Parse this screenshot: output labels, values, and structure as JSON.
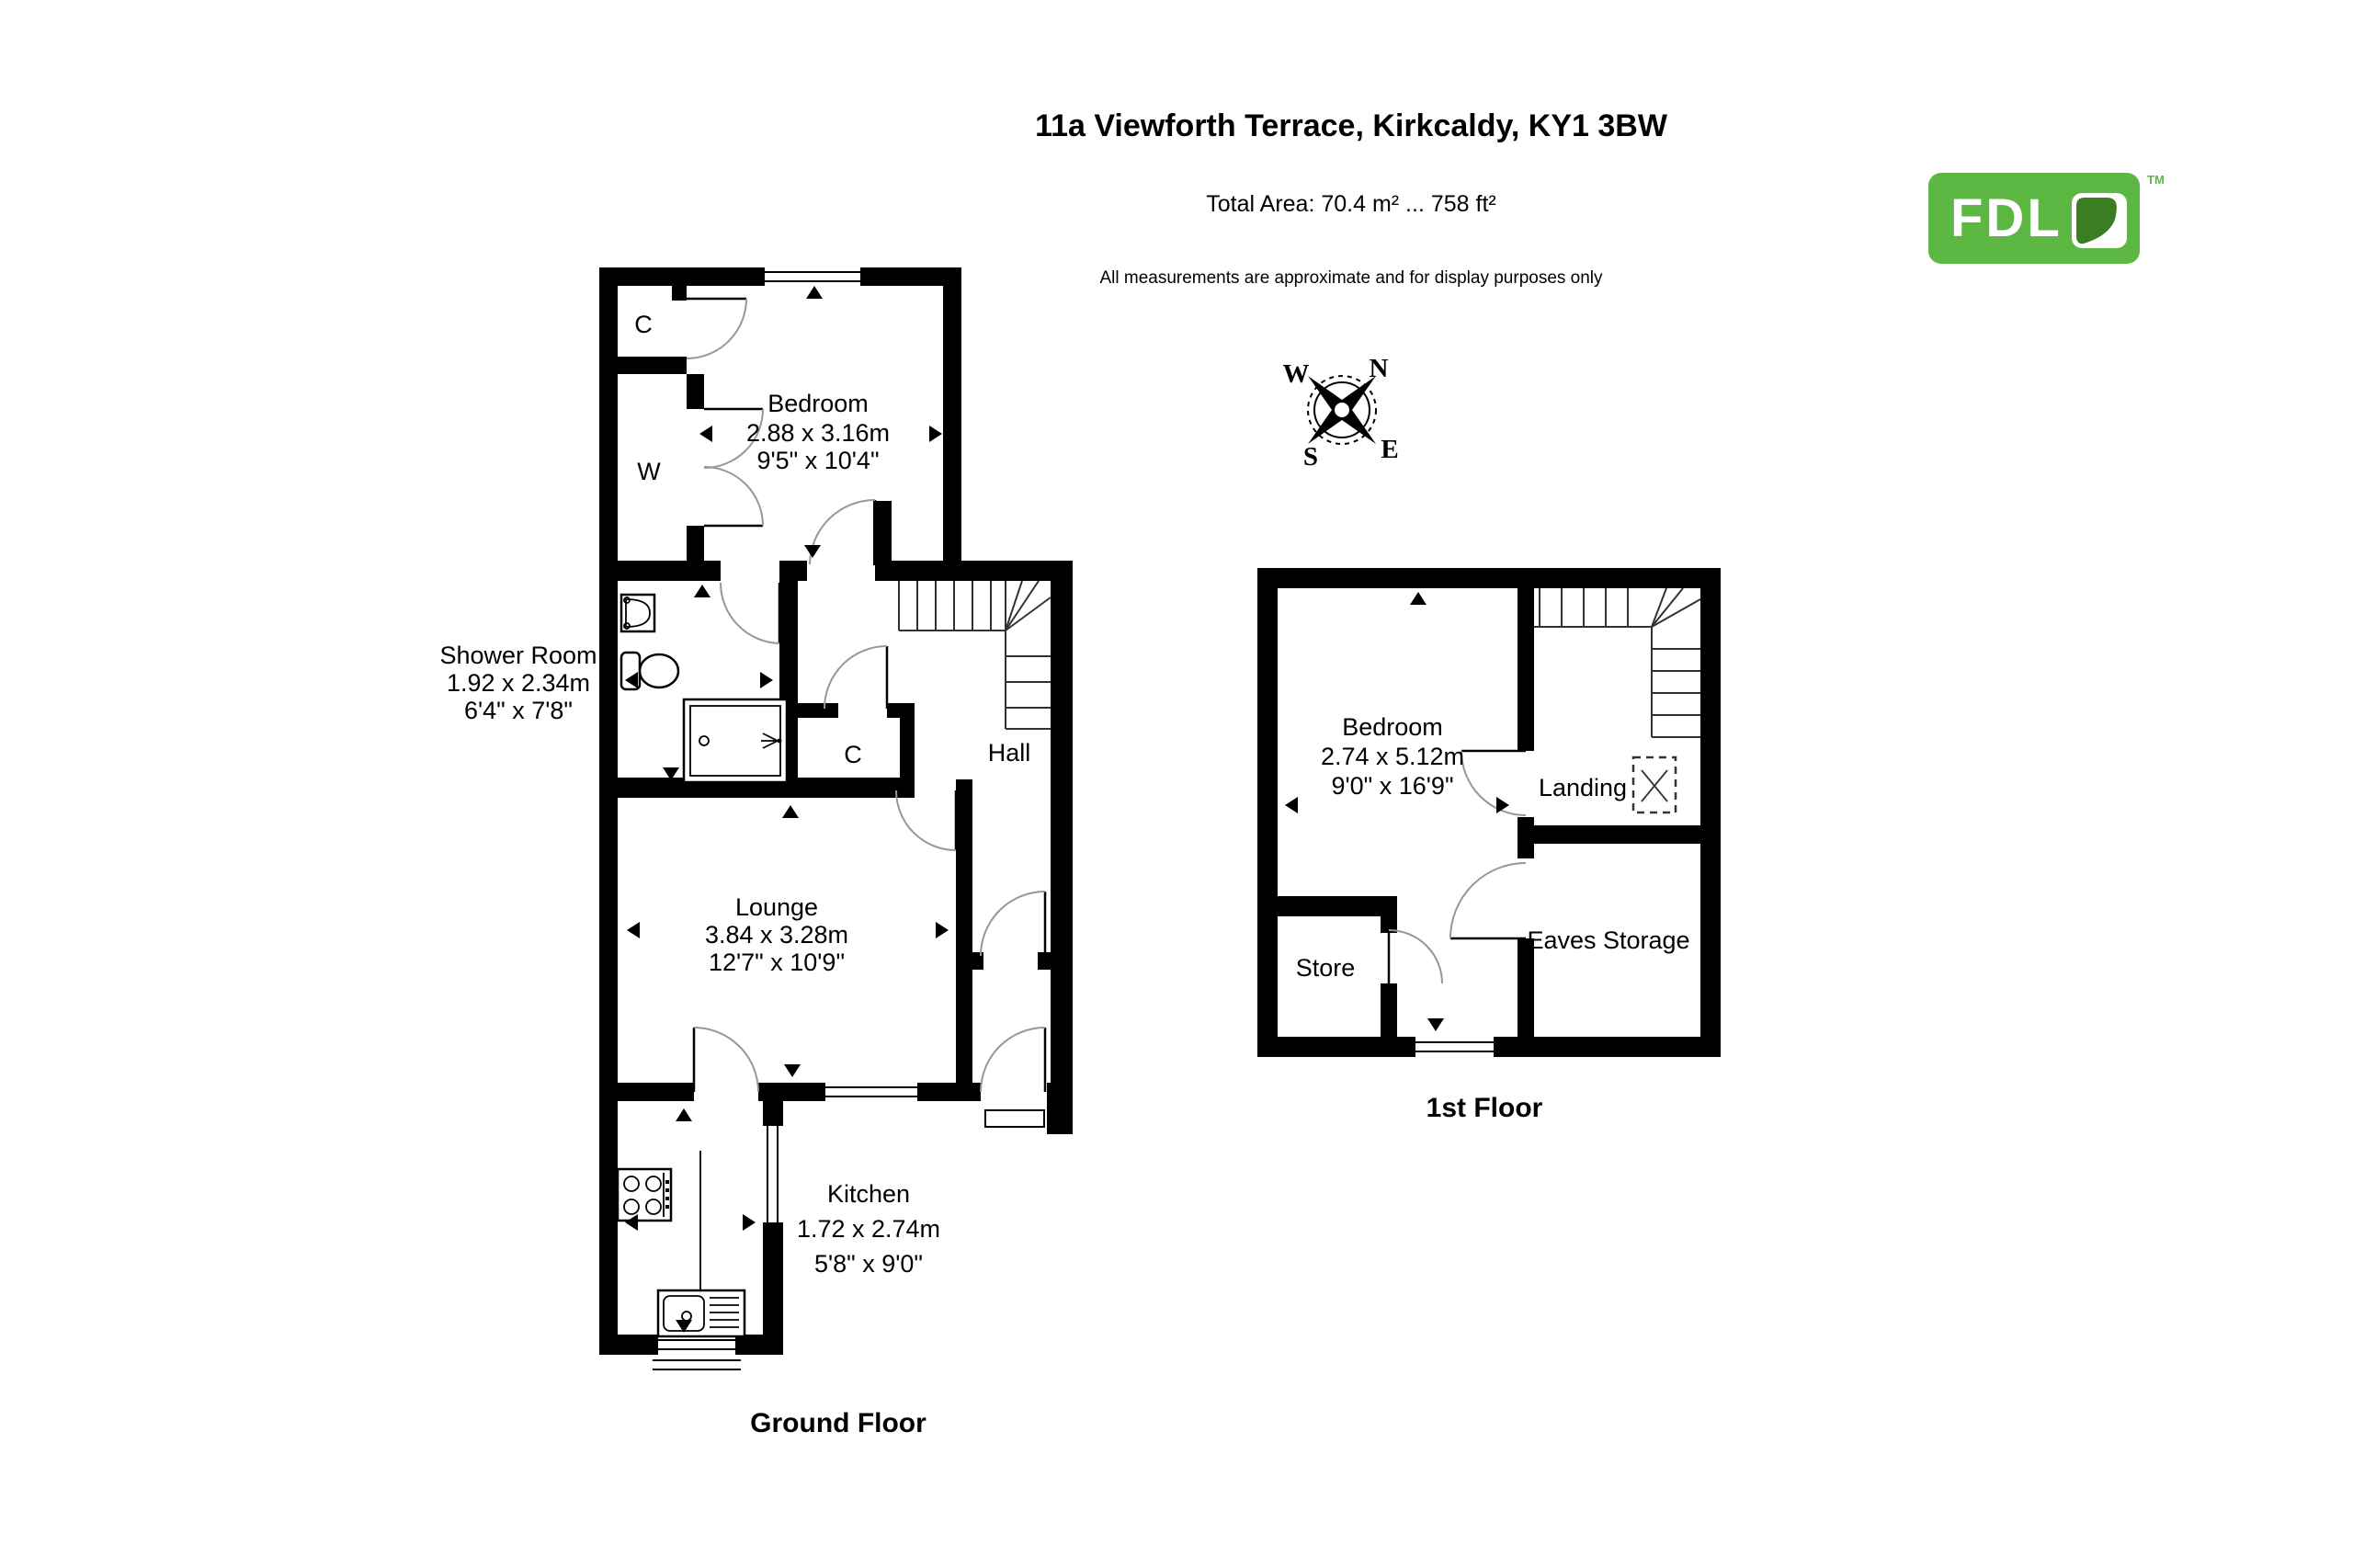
{
  "header": {
    "title": "11a Viewforth Terrace, Kirkcaldy, KY1 3BW",
    "total_area": "Total Area: 70.4 m² ... 758 ft²",
    "disclaimer": "All measurements are approximate and for display purposes only"
  },
  "logo": {
    "text": "FDL",
    "tm": "TM",
    "green": "#5cb843",
    "leaf_green": "#3b7d23"
  },
  "compass": {
    "n": "N",
    "e": "E",
    "s": "S",
    "w": "W"
  },
  "colors": {
    "wall": "#000000",
    "background": "#ffffff"
  },
  "ground_floor": {
    "label": "Ground Floor",
    "rooms": {
      "bedroom": {
        "name": "Bedroom",
        "metric": "2.88 x 3.16m",
        "imperial": "9'5\" x 10'4\""
      },
      "shower_room": {
        "name": "Shower Room",
        "metric": "1.92 x 2.34m",
        "imperial": "6'4\" x 7'8\""
      },
      "lounge": {
        "name": "Lounge",
        "metric": "3.84 x 3.28m",
        "imperial": "12'7\" x 10'9\""
      },
      "kitchen": {
        "name": "Kitchen",
        "metric": "1.72 x 2.74m",
        "imperial": "5'8\" x 9'0\""
      },
      "hall": {
        "name": "Hall"
      },
      "closet": {
        "name": "C"
      },
      "wardrobe": {
        "name": "W"
      },
      "hall_closet": {
        "name": "C"
      }
    }
  },
  "first_floor": {
    "label": "1st Floor",
    "rooms": {
      "bedroom": {
        "name": "Bedroom",
        "metric": "2.74 x 5.12m",
        "imperial": "9'0\" x 16'9\""
      },
      "landing": {
        "name": "Landing"
      },
      "eaves_storage": {
        "name": "Eaves Storage"
      },
      "store": {
        "name": "Store"
      }
    }
  }
}
